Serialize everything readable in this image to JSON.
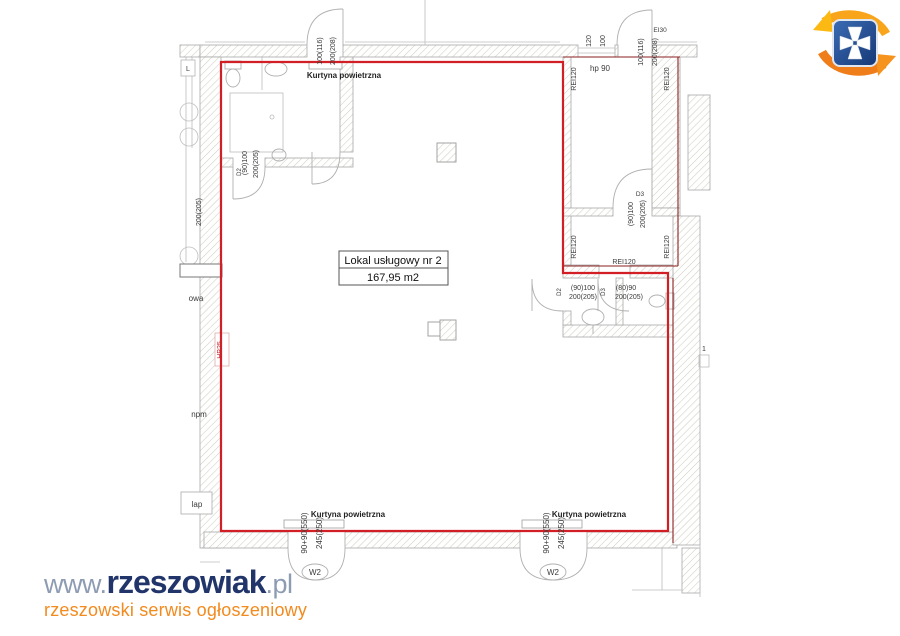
{
  "plan": {
    "unit": {
      "name": "Lokal usługowy nr 2",
      "area": "167,95 m2"
    },
    "labels": {
      "air_curtain": "Kurtyna powietrzna",
      "hp90": "hp 90",
      "ei30": "EI30",
      "rei120": "REI120",
      "hp25": "HP25",
      "w2": "W2",
      "npm": "npm",
      "lap": "lap",
      "owa": "owa",
      "l": "L",
      "room1": "1"
    },
    "dims": {
      "door_100_116": "100(116)",
      "door_200_208": "200(208)",
      "door_90_100": "(90)100",
      "door_200_205": "200(205)",
      "door_80_90": "(80)90",
      "win_120": "120",
      "win_100": "100",
      "w2_width": "90+90(550)",
      "w2_height": "245(250)",
      "code_d2": "D2",
      "code_d3": "D3"
    }
  },
  "watermark": {
    "www": "www.",
    "brand": "rzeszowiak",
    "tld": ".pl",
    "tagline": "rzeszowski serwis ogłoszeniowy"
  },
  "colors": {
    "boundary_red": "#d21f26",
    "fire_red": "#8e1f1f",
    "brand_navy": "#21356b",
    "brand_blue_gray": "#8d9bb3",
    "brand_orange": "#f28a1e",
    "crest_blue": "#2a52a2",
    "crest_orange": "#f6921e"
  }
}
